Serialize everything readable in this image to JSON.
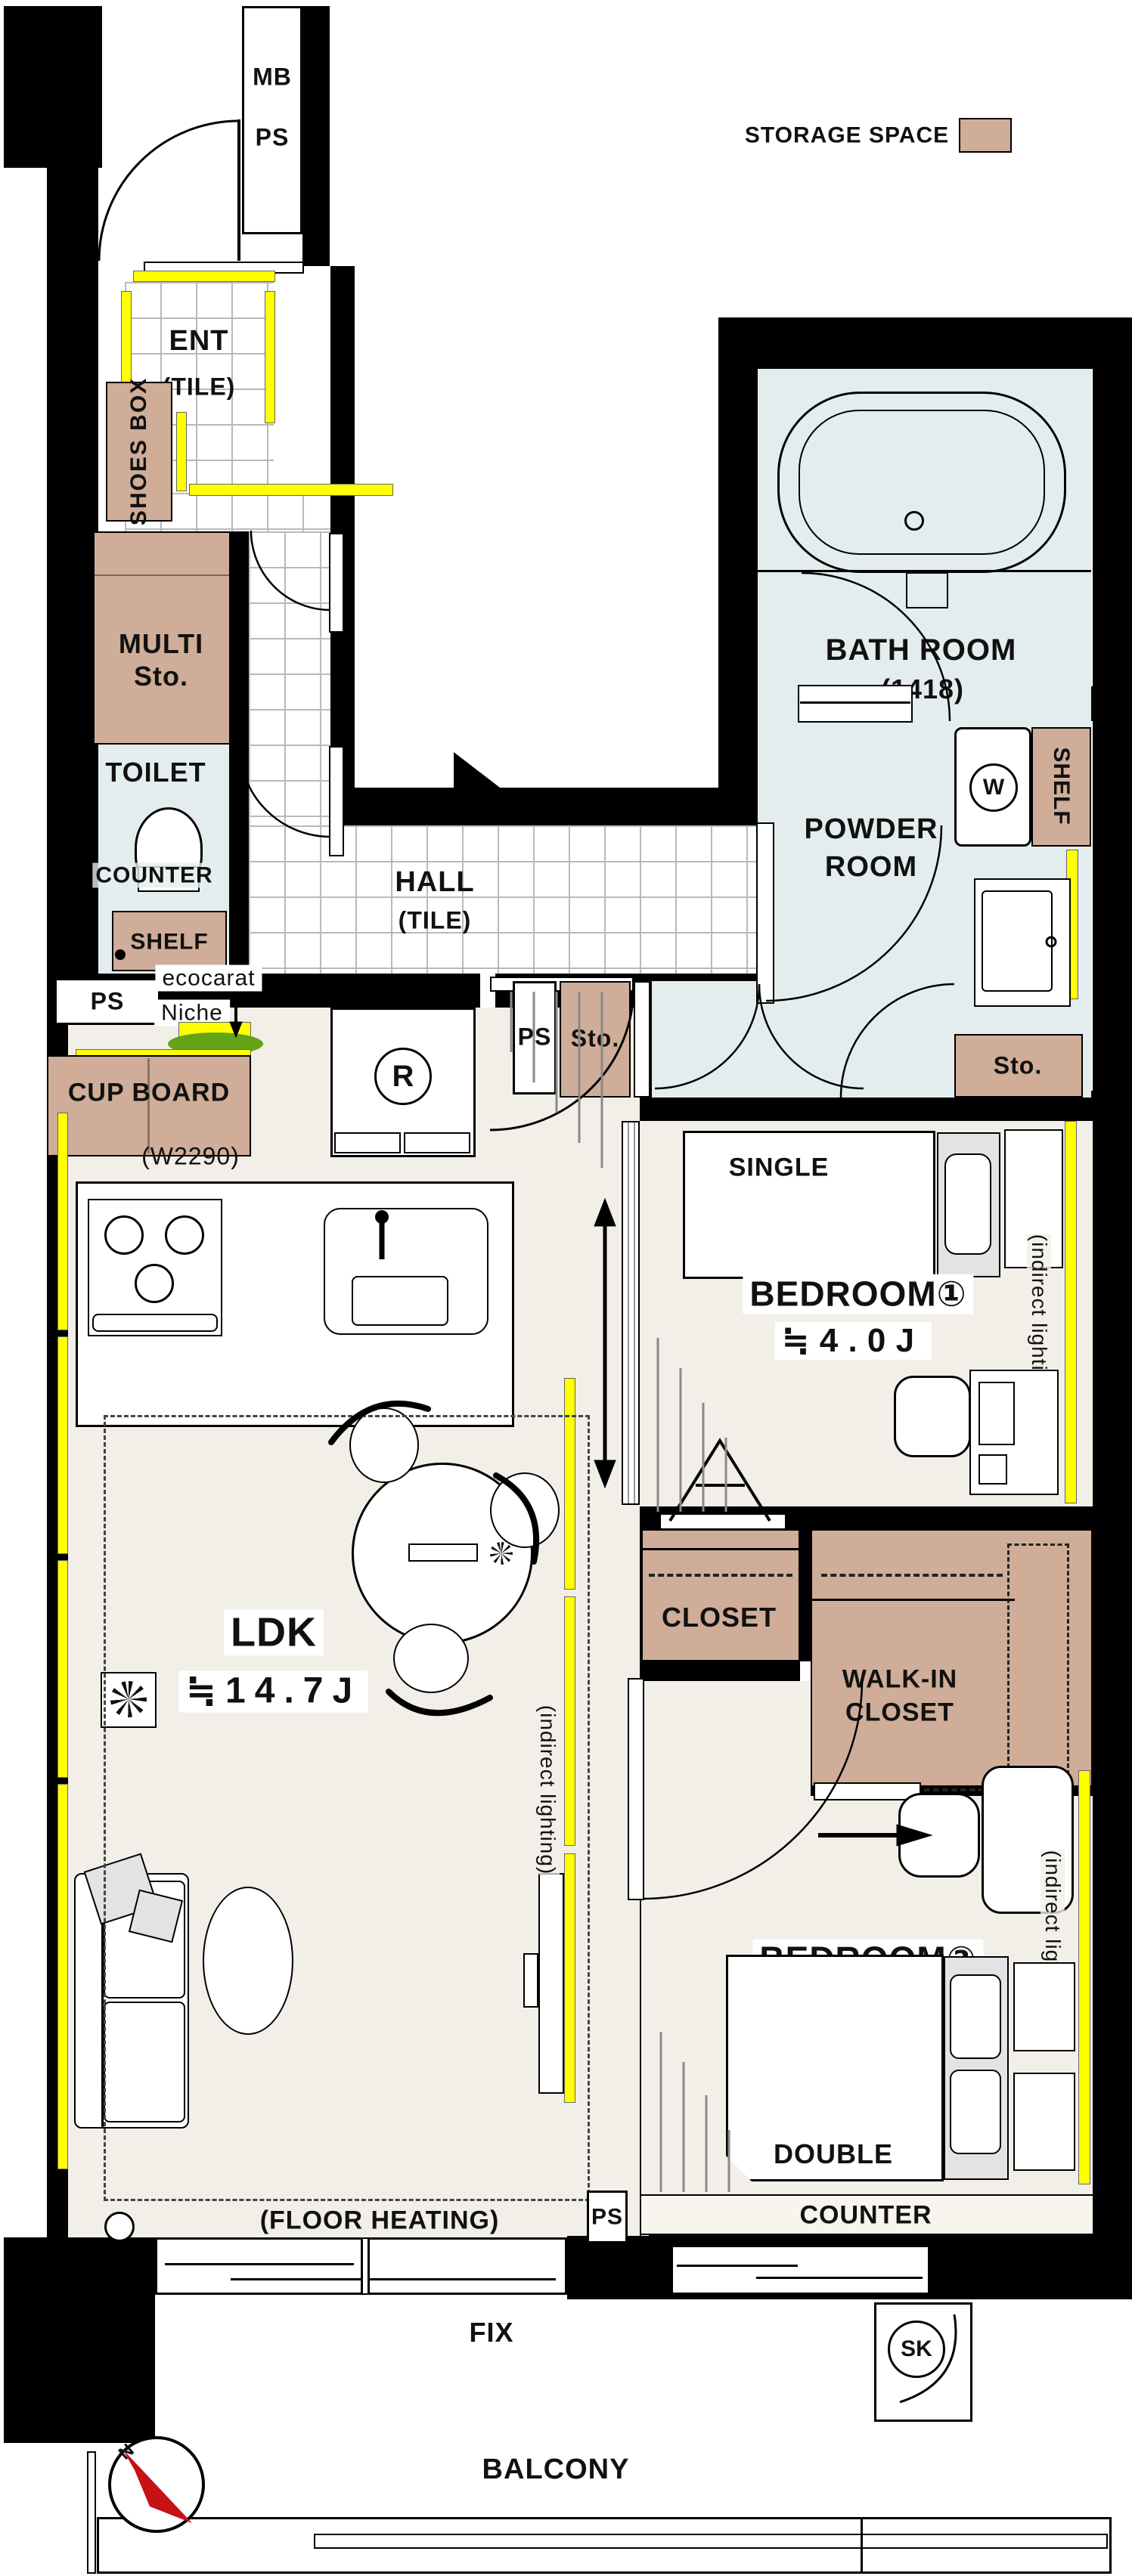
{
  "colors": {
    "wall": "#000000",
    "tan": "#cfad98",
    "wet": "#e4edee",
    "floor": "#f1efe7",
    "tile_line": "#b9b9b9",
    "highlight_yellow": "#ffff00",
    "niche_green": "#63a417",
    "compass_red": "#c41215"
  },
  "legend": {
    "storage_space": "STORAGE SPACE"
  },
  "meter_box": {
    "mb": "MB",
    "ps": "PS"
  },
  "entrance": {
    "shoes_box": "SHOES BOX",
    "name": "ENT",
    "floor": "(TILE)",
    "multi_line1": "MULTI",
    "multi_line2": "Sto."
  },
  "toilet": {
    "name": "TOILET",
    "counter": "COUNTER",
    "shelf": "SHELF",
    "ps": "PS"
  },
  "hall": {
    "name": "HALL",
    "floor": "(TILE)",
    "ecocarat": "ecocarat",
    "niche": "Niche",
    "cup_board": "CUP BOARD",
    "fridge": "R"
  },
  "kitchen": {
    "width_note": "(W2290)"
  },
  "bath": {
    "name": "BATH ROOM",
    "size": "(1418)",
    "washer": "W",
    "shelf": "SHELF"
  },
  "powder": {
    "line1": "POWDER",
    "line2": "ROOM",
    "ps": "PS",
    "sto_left": "Sto.",
    "sto_right": "Sto."
  },
  "ldk": {
    "name": "LDK",
    "size": "≒14.7J",
    "floor_heating": "(FLOOR HEATING)",
    "indirect": "(indirect lighting)",
    "ps": "PS"
  },
  "bedroom1": {
    "name": "BEDROOM①",
    "size": "≒4.0J",
    "bed": "SINGLE"
  },
  "bedroom2": {
    "name": "BEDROOM②",
    "size": "≒5.5J",
    "bed": "DOUBLE",
    "counter": "COUNTER"
  },
  "closets": {
    "closet": "CLOSET",
    "wic_line1": "WALK-IN",
    "wic_line2": "CLOSET"
  },
  "balcony": {
    "name": "BALCONY",
    "fix": "FIX",
    "sk": "SK",
    "compass_n": "N"
  }
}
